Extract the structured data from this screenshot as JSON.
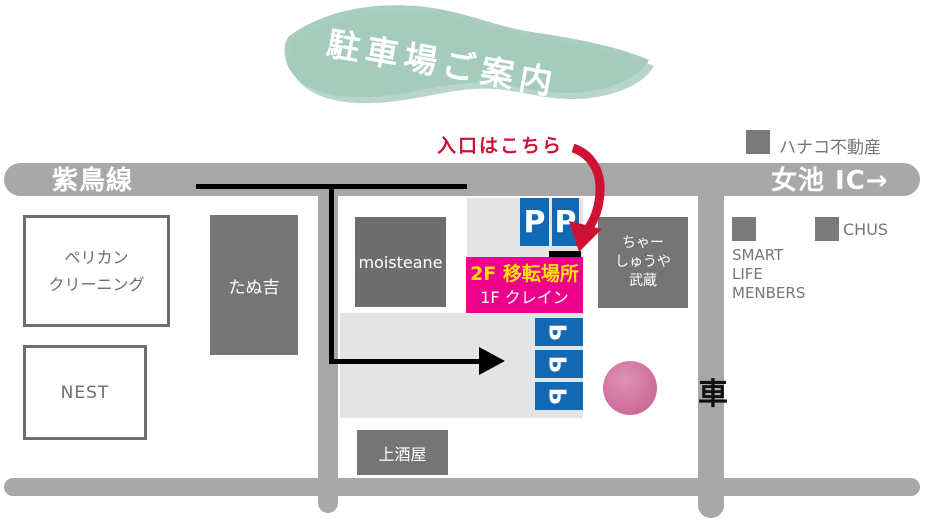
{
  "banner": {
    "title": "駐車場ご案内"
  },
  "roads": {
    "shicho_line": "紫鳥線",
    "meike_ic": "女池 IC→"
  },
  "landmarks": {
    "hanako_estate": "ハナコ不動産",
    "chus": "CHUS",
    "smart_life": [
      "SMART",
      "LIFE",
      "MENBERS"
    ],
    "car_kanji": "車"
  },
  "buildings": {
    "pelican_cleaning": [
      "ペリカン",
      "クリーニング"
    ],
    "nest": "NEST",
    "tanukichi": "たぬ吉",
    "moisteane": "moisteane",
    "kami_sakaya": "上酒屋",
    "chashuya_musashi": [
      "ちゃー",
      "しゅうや",
      "武蔵"
    ]
  },
  "destination": {
    "floor2": "2F 移転場所",
    "floor1": "1F クレイン"
  },
  "entrance": {
    "label": "入口はこちら"
  },
  "parking": {
    "symbol": "P"
  },
  "colors": {
    "road": "#a8a8a8",
    "building": "#757575",
    "building_dark": "#6e6e6e",
    "parking_lot": "#e4e4e4",
    "magenta": "#ec008c",
    "blue": "#1168b3",
    "red": "#cf1134",
    "yellow": "#ffe100",
    "teal": "#a3cabc",
    "teal_dark": "#88b9a9",
    "gray_text": "#767676",
    "circle_pink": "#d2739f"
  }
}
